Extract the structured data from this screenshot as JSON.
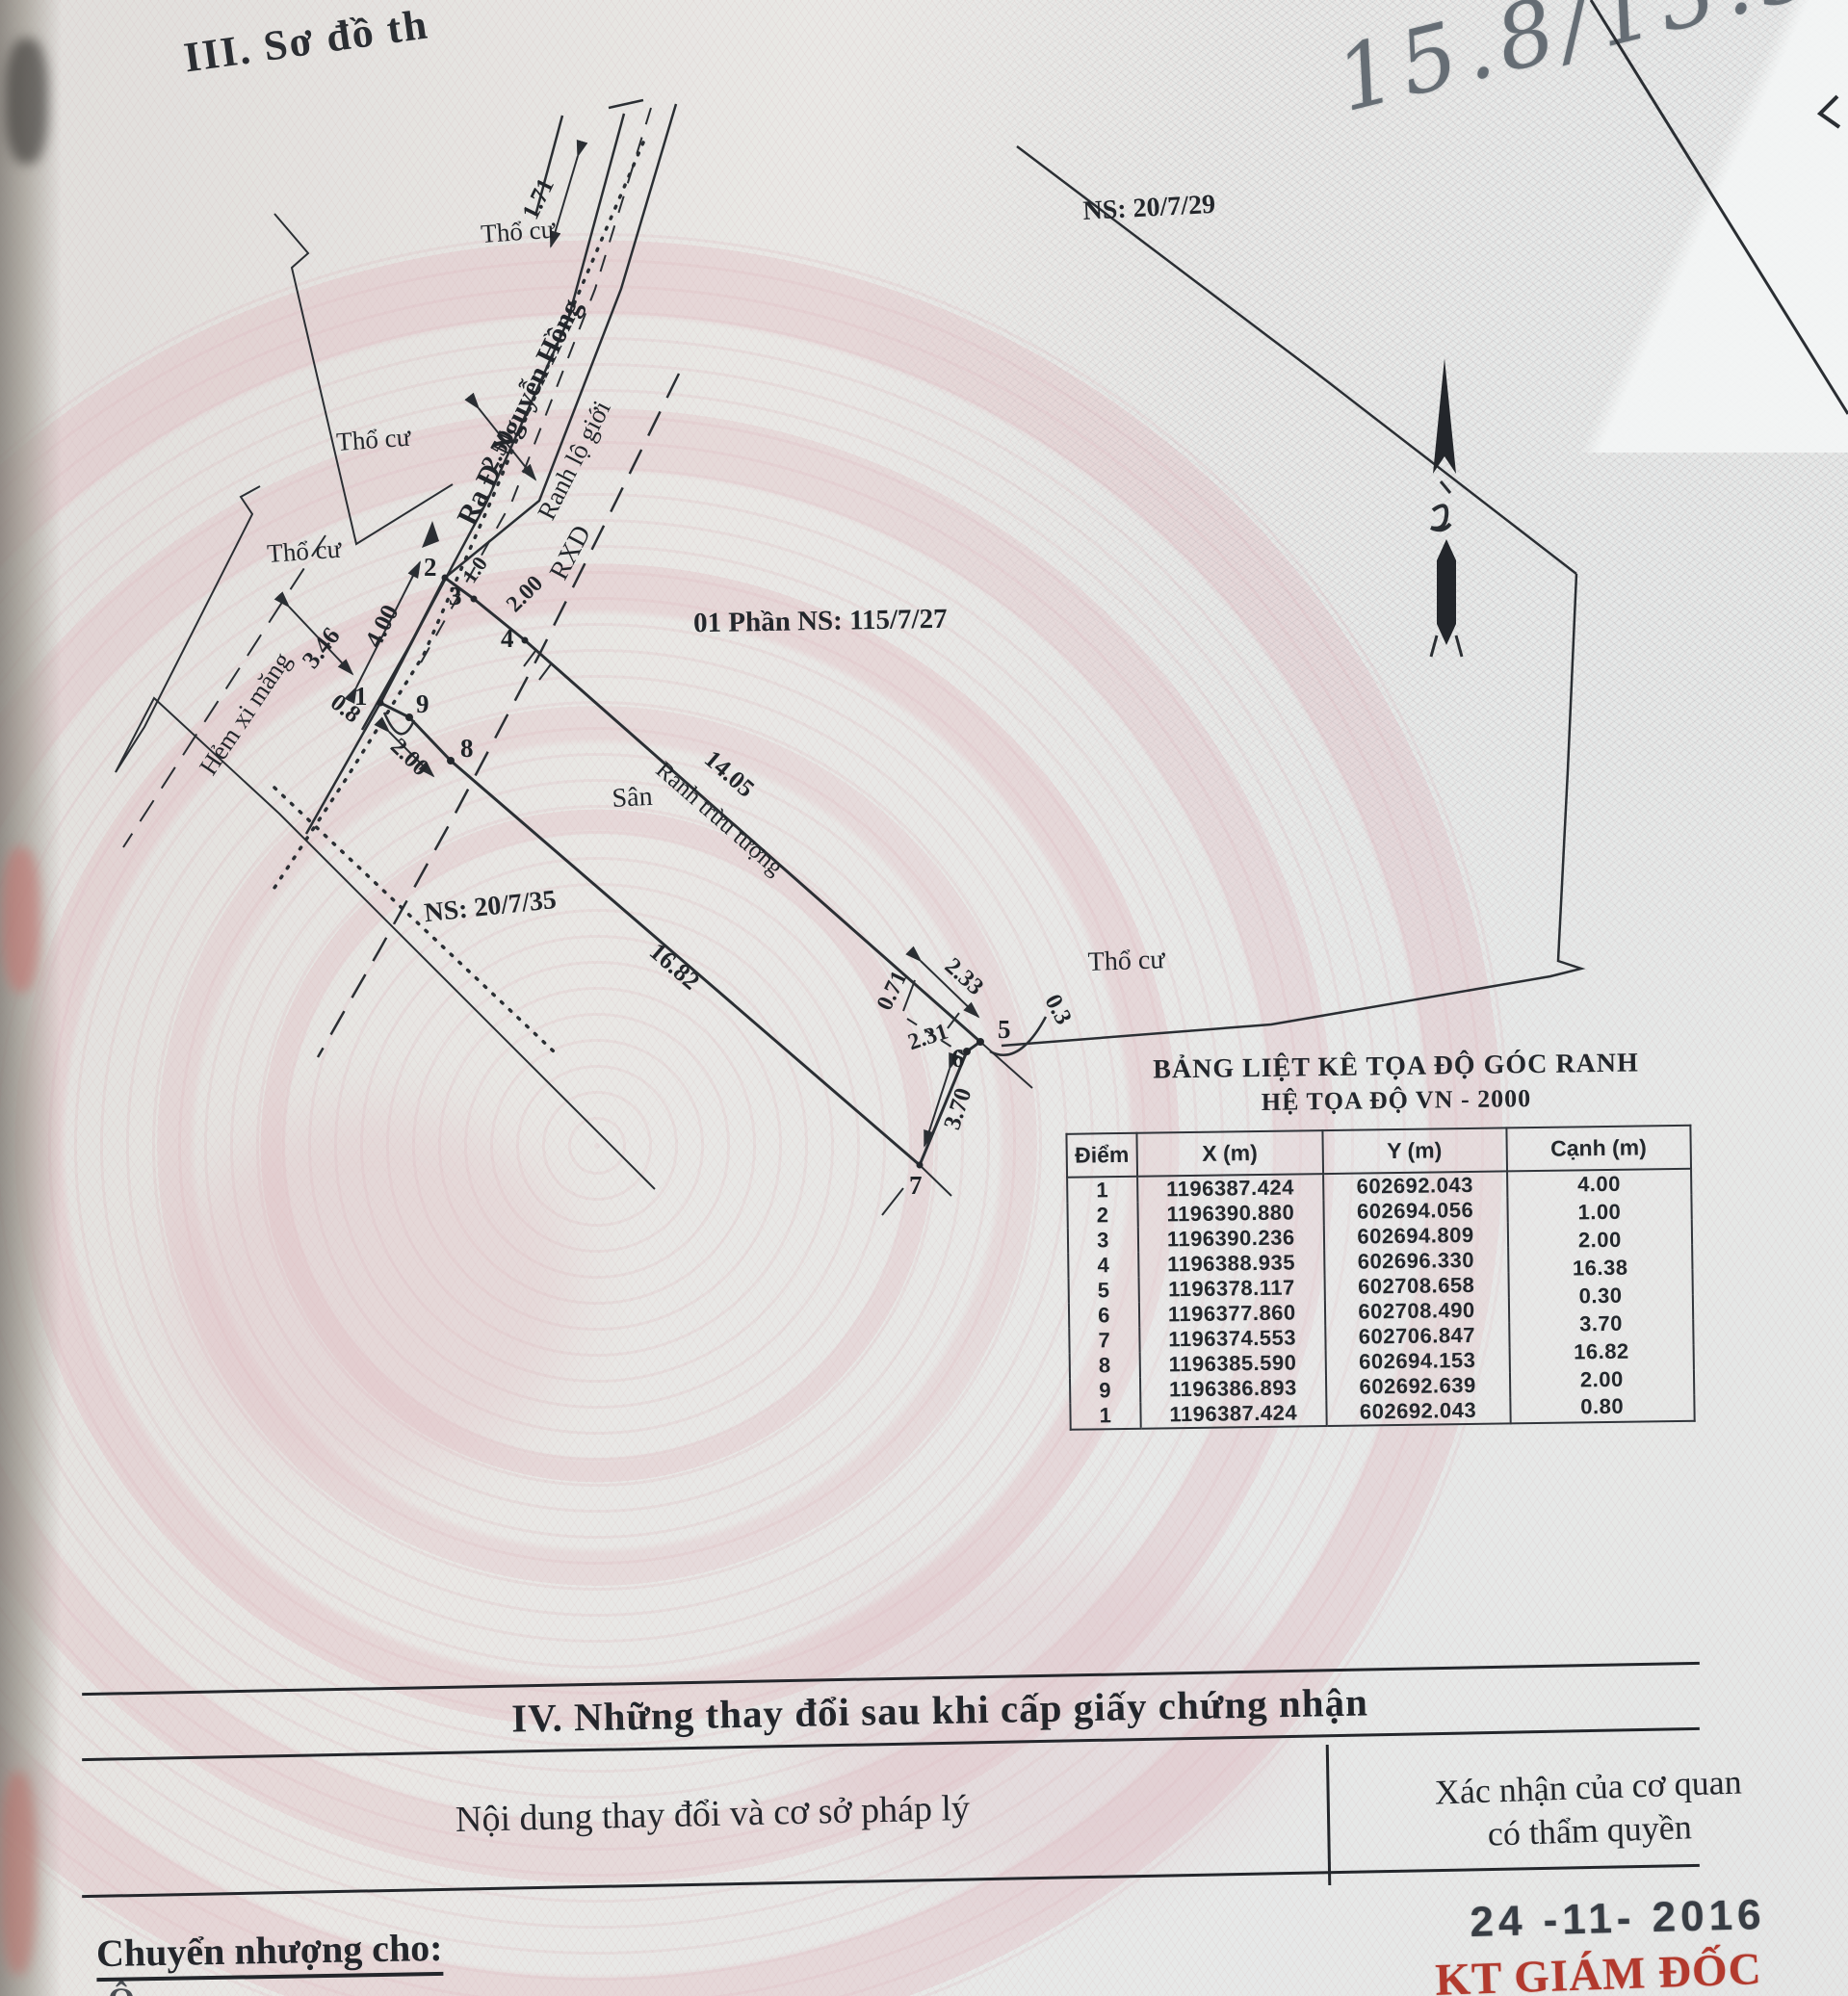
{
  "page": {
    "section3_heading": "III. Sơ đồ th",
    "handwritten_note": "15.8/13.5"
  },
  "colors": {
    "ink": "#23262b",
    "stamp_red": "#b23a2e",
    "pencil": "#5a626a",
    "guilloche_pink": "#e0b2ba"
  },
  "diagram": {
    "labels": {
      "tho_cu": "Thổ cư",
      "ra_duong": "Ra Đ. Nguyễn Hồng",
      "ranh_lo_gioi": "Ranh lộ giới",
      "rxd": "RXD",
      "ns_top": "NS: 20/7/29",
      "phan_ns": "01 Phần NS: 115/7/27",
      "ns_left": "NS: 20/7/35",
      "san": "Sân",
      "ranh_truu_tuong": "Ranh trừu tượng",
      "hem_xi_mang": "Hẻm xi măng"
    },
    "dims": {
      "d171": "1.71",
      "d250": "2.50",
      "d100": "1.0",
      "d200a": "2.00",
      "d400": "4.00",
      "d346": "3.46",
      "d08": "0.8",
      "d200b": "2.00",
      "d1405": "14.05",
      "d1682": "16.82",
      "d233": "2.33",
      "d071": "0.71",
      "d231": "2.31",
      "d03": "0.3",
      "d370": "3.70"
    },
    "points": {
      "p1": "1",
      "p2": "2",
      "p3": "3",
      "p4": "4",
      "p5": "5",
      "p6": "6",
      "p7": "7",
      "p8": "8",
      "p9": "9"
    }
  },
  "table": {
    "title1": "BẢNG LIỆT KÊ TỌA ĐỘ GÓC RANH",
    "title2": "HỆ TỌA ĐỘ VN - 2000",
    "headers": [
      "Điểm",
      "X (m)",
      "Y (m)",
      "Cạnh (m)"
    ],
    "rows": [
      {
        "p": "1",
        "x": "1196387.424",
        "y": "602692.043"
      },
      {
        "p": "2",
        "x": "1196390.880",
        "y": "602694.056"
      },
      {
        "p": "3",
        "x": "1196390.236",
        "y": "602694.809"
      },
      {
        "p": "4",
        "x": "1196388.935",
        "y": "602696.330"
      },
      {
        "p": "5",
        "x": "1196378.117",
        "y": "602708.658"
      },
      {
        "p": "6",
        "x": "1196377.860",
        "y": "602708.490"
      },
      {
        "p": "7",
        "x": "1196374.553",
        "y": "602706.847"
      },
      {
        "p": "8",
        "x": "1196385.590",
        "y": "602694.153"
      },
      {
        "p": "9",
        "x": "1196386.893",
        "y": "602692.639"
      },
      {
        "p": "1",
        "x": "1196387.424",
        "y": "602692.043"
      }
    ],
    "edges": [
      "4.00",
      "1.00",
      "2.00",
      "16.38",
      "0.30",
      "3.70",
      "16.82",
      "2.00",
      "0.80"
    ]
  },
  "section4": {
    "title": "IV. Những thay đổi sau khi cấp giấy chứng nhận",
    "left_header": "Nội dung thay đổi và cơ sở pháp lý",
    "right_header_line1": "Xác nhận của cơ quan",
    "right_header_line2": "có thẩm quyền",
    "date_stamp": "24 -11- 2016",
    "transfer_label": "Chuyển nhượng cho:",
    "next_line_start": "Ô",
    "signer_title": "KT GIÁM ĐỐC"
  }
}
